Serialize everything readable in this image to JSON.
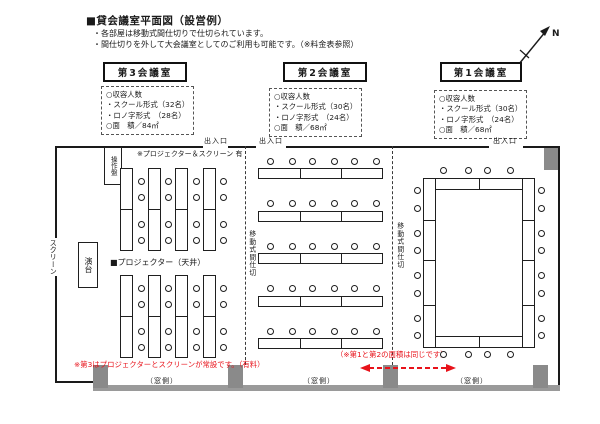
{
  "header": {
    "title": "■貸会議室平面図（設営例）",
    "notes": [
      "・各部屋は移動式間仕切りで仕切られています。",
      "・間仕切りを外して大会議室としてのご利用も可能です。（※料金表参照）"
    ]
  },
  "north": {
    "label": "N"
  },
  "rooms": [
    {
      "name": "第3会議室",
      "lines": [
        "○収容人数",
        "・スクール形式（32名）",
        "・ロノ字形式　（28名）",
        "○面　積／84㎡"
      ]
    },
    {
      "name": "第2会議室",
      "lines": [
        "○収容人数",
        "・スクール形式（30名）",
        "・ロノ字形式　（24名）",
        "○面　積／68㎡"
      ]
    },
    {
      "name": "第1会議室",
      "lines": [
        "○収容人数",
        "・スクール形式（30名）",
        "・ロノ字形式　（24名）",
        "○面　積／68㎡"
      ]
    }
  ],
  "floor": {
    "exit_label": "出入口",
    "window_label": "（窓側）",
    "partition_label": "移動式間仕切",
    "control_panel_label": "操作盤",
    "screen_label": "スクリーン",
    "podium_label": "演台",
    "projector_available_note": "※プロジェクター＆スクリーン 有",
    "ceiling_projector_label": "■プロジェクター（天井）",
    "room3_note": "※第3はプロジェクターとスクリーンが常設です。（有料）",
    "room12_note": "（※第1と第2の面積は同じです）"
  },
  "colors": {
    "line": "#1a1a1a",
    "red": "#e8121a",
    "pillar": "#8a8a8a",
    "window_band": "#9a9a9a"
  }
}
